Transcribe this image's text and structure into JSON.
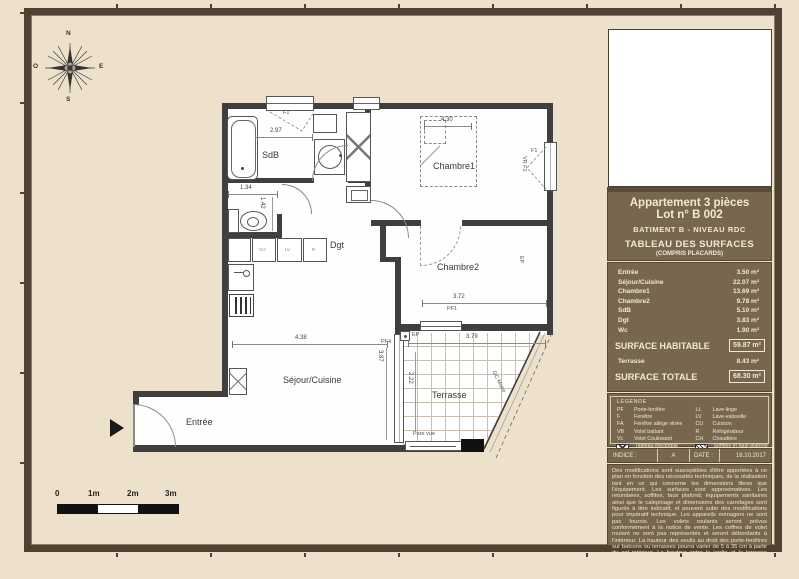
{
  "page": {
    "background": "#EDE1CB",
    "frame_color": "#4E4234",
    "panel_brown": "#77674F",
    "wall_color": "#3F3F3F"
  },
  "compass": {
    "n": "N",
    "e": "E",
    "s": "S",
    "o": "O"
  },
  "sidebar": {
    "title_block": {
      "line1": "Appartement 3 pièces",
      "line2": "Lot n° B 002",
      "building_line": "BATIMENT B - NIVEAU RDC",
      "table_title": "TABLEAU DES SURFACES",
      "table_subtitle": "(COMPRIS PLACARDS)"
    },
    "surfaces": {
      "rows": [
        {
          "label": "Entrée",
          "value": "3.50 m²"
        },
        {
          "label": "Séjour/Cuisine",
          "value": "22.07 m²"
        },
        {
          "label": "Chambre1",
          "value": "13.69 m²"
        },
        {
          "label": "Chambre2",
          "value": "9.78 m²"
        },
        {
          "label": "SdB",
          "value": "5.10 m²"
        },
        {
          "label": "Dgt",
          "value": "3.83 m²"
        },
        {
          "label": "Wc",
          "value": "1.90 m²"
        }
      ],
      "habitable_label": "SURFACE HABITABLE",
      "habitable_value": "59.87 m²",
      "terrasse_label": "Terrasse",
      "terrasse_value": "8.43 m²",
      "totale_label": "SURFACE TOTALE",
      "totale_value": "68.30 m²"
    },
    "legend": {
      "title": "LEGENDE",
      "left": [
        {
          "abbr": "PF",
          "label": "Porte-fenêtre"
        },
        {
          "abbr": "F",
          "label": "Fenêtre"
        },
        {
          "abbr": "FA",
          "label": "Fenêtre allège vitrée"
        },
        {
          "abbr": "VB",
          "label": "Volet battant"
        },
        {
          "abbr": "Vc",
          "label": "Volet Coulissant"
        },
        {
          "abbr": "",
          "label": "Tableau électrique"
        }
      ],
      "right": [
        {
          "abbr": "LL",
          "label": "Lave-linge"
        },
        {
          "abbr": "LV",
          "label": "Lave-vaisselle"
        },
        {
          "abbr": "CU",
          "label": "Cuisson"
        },
        {
          "abbr": "R",
          "label": "Réfrigérateur"
        },
        {
          "abbr": "CH",
          "label": "Chaudière"
        },
        {
          "abbr": "",
          "label": "Soffites et faux-plafond"
        }
      ]
    },
    "meta": {
      "indice_label": "INDICE :",
      "indice_value": "A",
      "date_label": "DATE :",
      "date_value": "16.10.2017"
    },
    "disclaimer": "Des modifications sont susceptibles d'être apportées à ce plan en fonction des nécessités techniques, de la réalisation tant en ce qui concerne les dimensions libres que l'équipement. Les surfaces sont approximatives. Les retombées, soffites, faux plafond, équipements sanitaires ainsi que le calepinage et dimensions des carrelages sont figurés à titre indicatif, et peuvent subir des modifications pour impératif technique. Les appareils ménagers ne sont pas fournis. Les volets roulants seront prévus conformément à la notice de vente. Les coffres de volet roulant ne sont pas représentés et seront débordants à l'intérieur. La hauteur des seuils au droit des porte-fenêtres sur balcons ou terrasses pourra varier de 5 à 35 cm à partir du sol intérieur. La hauteur entre le jardin et la terrasse pourra varier entre 0 et 60 cm. Les jardins ne seront pas nécessairement plats et pourront comporter des talus et des pentes."
  },
  "plan": {
    "rooms": {
      "sdb": "SdB",
      "chambre1": "Chambre1",
      "chambre2": "Chambre2",
      "dgt": "Dgt",
      "sejour": "Séjour/Cuisine",
      "entree": "Entrée",
      "terrasse": "Terrasse"
    },
    "openings": {
      "f1_top": "F1",
      "f1_right": "F1",
      "vr_f1": "VR F1",
      "pf1": "PF1",
      "pf4": "PF4",
      "ep": "EP",
      "ep_right": "EP"
    },
    "annotations": {
      "pare_vue": "Pare vue",
      "gc_moire": "GC Moiré"
    },
    "appliances": {
      "cu": "CU",
      "lv": "LV",
      "r": "R"
    },
    "dimensions": {
      "sdb_w": "2.97",
      "ch1_w": "4.30",
      "wc_w": "1.34",
      "wc_h": "1.42",
      "ch2_w": "3.72",
      "sejour_w": "4.38",
      "terrasse_w": "3.79",
      "sejour_h": "3.87",
      "terrasse_h": "2.22"
    },
    "scale": {
      "t0": "0",
      "t1": "1m",
      "t2": "2m",
      "t3": "3m"
    }
  }
}
